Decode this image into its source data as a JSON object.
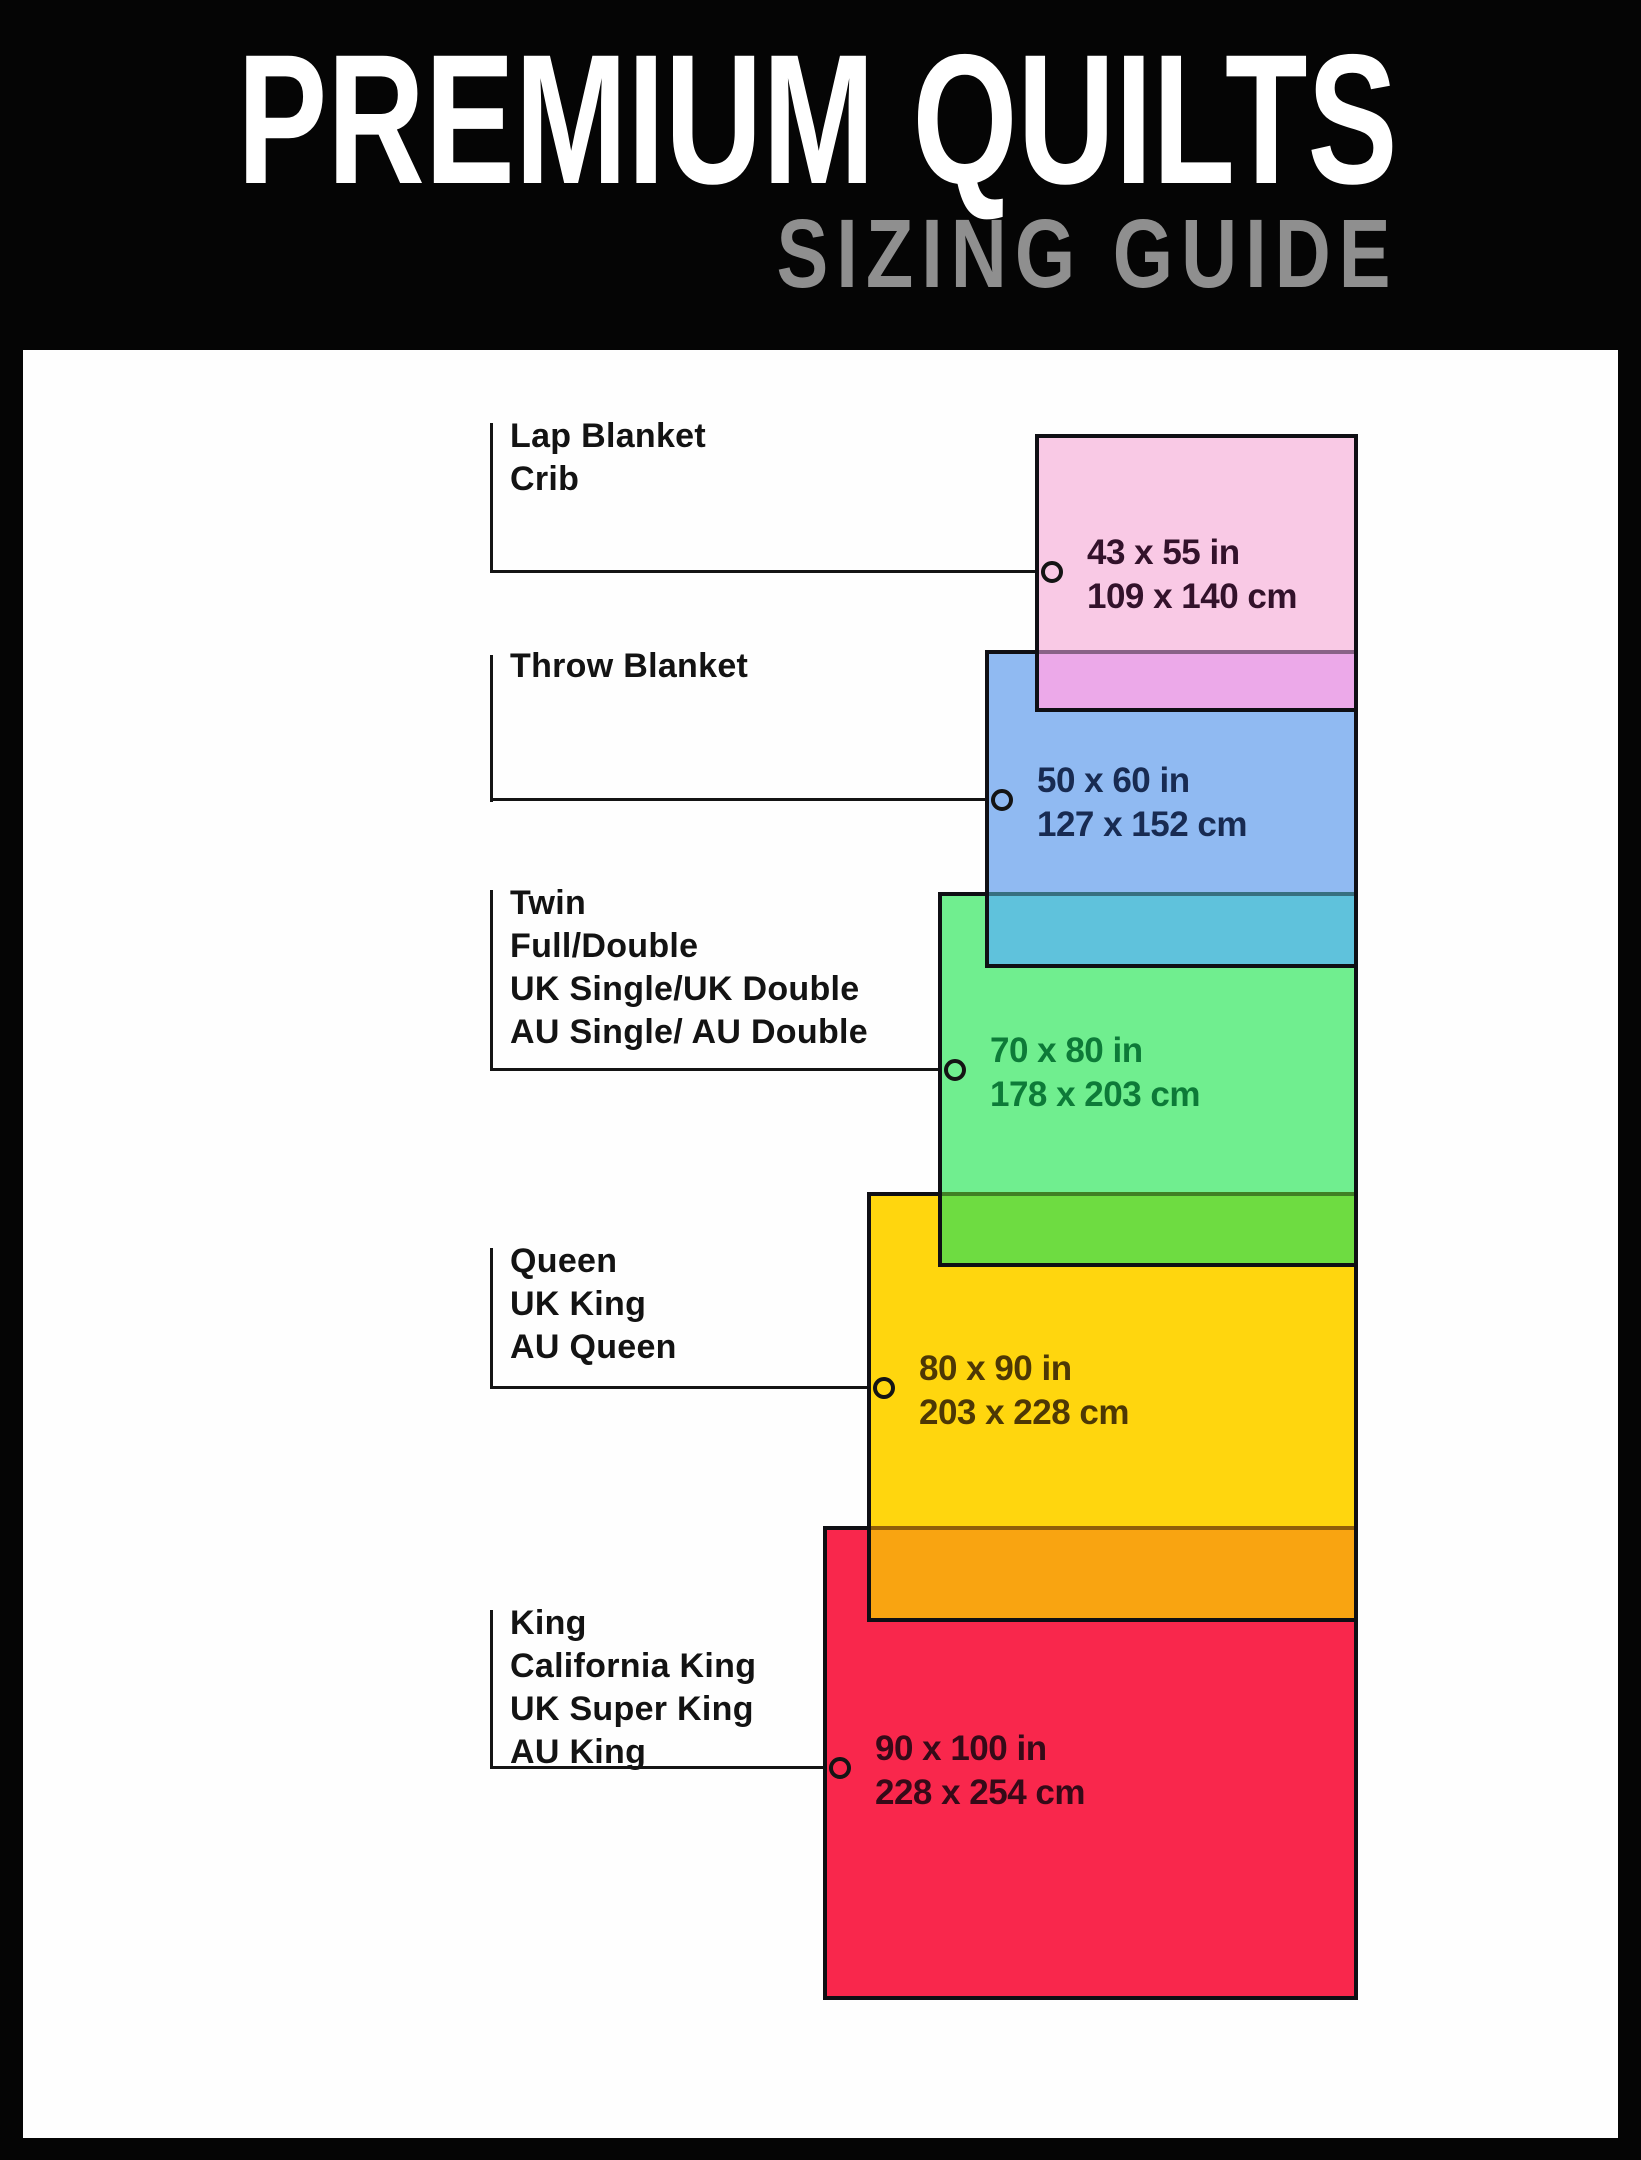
{
  "header": {
    "title": "PREMIUM QUILTS",
    "subtitle": "SIZING GUIDE"
  },
  "colors": {
    "background": "#050505",
    "panel": "#fefefe",
    "title_text": "#ffffff",
    "subtitle_text": "#8f8f8f",
    "label_text": "#131313",
    "line": "#141414",
    "rect_border": "#0f0f14"
  },
  "sizes": [
    {
      "labels": [
        "Lap Blanket",
        "Crib"
      ],
      "inches": "43 x 55 in",
      "cm": "109 x 140 cm",
      "fill": "#f9c9e5",
      "overlap_fill": "#eca9e9",
      "dim_text_color": "#33122b"
    },
    {
      "labels": [
        "Throw Blanket"
      ],
      "inches": "50 x 60 in",
      "cm": "127 x 152 cm",
      "fill": "#90baf2",
      "overlap_fill": "#5fc2dc",
      "dim_text_color": "#182b52"
    },
    {
      "labels": [
        "Twin",
        "Full/Double",
        "UK Single/UK Double",
        "AU Single/ AU Double"
      ],
      "inches": "70 x 80 in",
      "cm": "178 x 203 cm",
      "fill": "#70ee8f",
      "overlap_fill": "#6edc41",
      "dim_text_color": "#0d7a38"
    },
    {
      "labels": [
        "Queen",
        "UK King",
        "AU Queen"
      ],
      "inches": "80 x 90 in",
      "cm": "203 x 228 cm",
      "fill": "#ffd60e",
      "overlap_fill": "#f9a411",
      "dim_text_color": "#4d3805"
    },
    {
      "labels": [
        "King",
        "California King",
        "UK Super King",
        "AU King"
      ],
      "inches": "90 x 100 in",
      "cm": "228 x 254 cm",
      "fill": "#f9274c",
      "overlap_fill": null,
      "dim_text_color": "#350a18"
    }
  ]
}
